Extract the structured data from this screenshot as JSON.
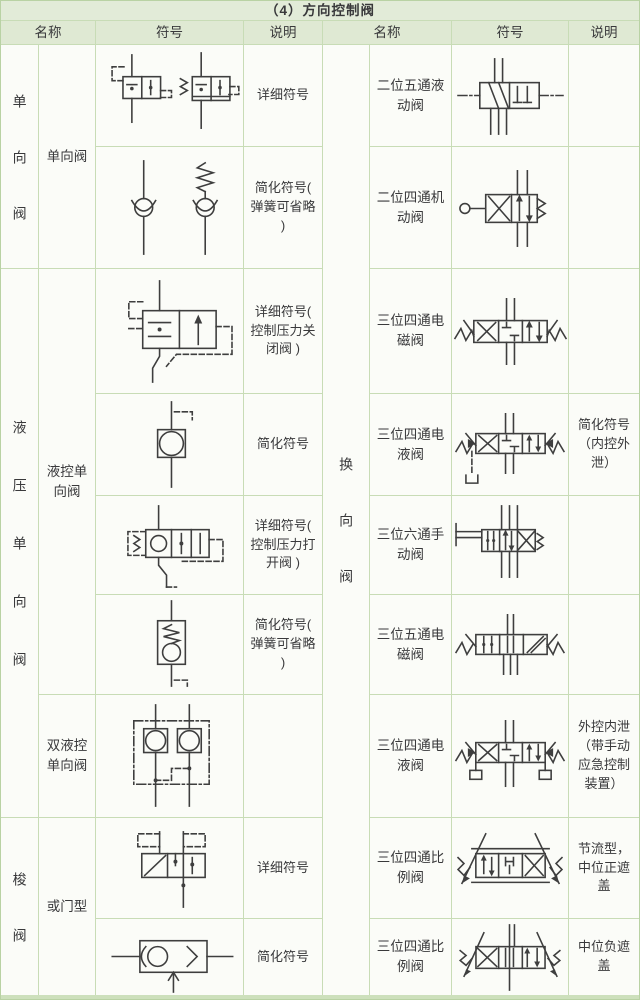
{
  "title": "（4）方向控制阀",
  "columns": {
    "name": "名称",
    "symbol": "符号",
    "desc": "说明"
  },
  "colors": {
    "header_bg": "#dfe9d3",
    "title_bg": "#e2ebd8",
    "grid_line": "#c8dcb6",
    "outer_border": "#b9d2a4",
    "ink": "#39393b",
    "symbol_ink": "#3e3e3e"
  },
  "left": {
    "groups": [
      {
        "label": "单向阀"
      },
      {
        "label": "液压单向阀"
      },
      {
        "label": "梭阀"
      }
    ],
    "subnames": [
      {
        "name": "单向阀"
      },
      {
        "name": "液控单向阀"
      },
      {
        "name": "双液控单向阀"
      },
      {
        "name": "或门型"
      }
    ],
    "rows": [
      {
        "desc": "详细符号",
        "symbol": "check-valve-detailed"
      },
      {
        "desc": "简化符号( 弹簧可省略 )",
        "symbol": "check-valve-simplified"
      },
      {
        "desc": "详细符号( 控制压力关闭阀 )",
        "symbol": "pilot-check-valve-close-detailed"
      },
      {
        "desc": "简化符号",
        "symbol": "pilot-check-valve-simplified"
      },
      {
        "desc": "详细符号( 控制压力打开阀 )",
        "symbol": "pilot-check-valve-open-detailed"
      },
      {
        "desc": "简化符号( 弹簧可省略 )",
        "symbol": "pilot-check-valve-spring-simplified"
      },
      {
        "desc": "",
        "symbol": "double-pilot-check-valve"
      },
      {
        "desc": "详细符号",
        "symbol": "shuttle-valve-detailed"
      },
      {
        "desc": "简化符号",
        "symbol": "shuttle-valve-simplified"
      }
    ]
  },
  "right": {
    "label": "换向阀",
    "rows": [
      {
        "name": "二位五通液动阀",
        "desc": "",
        "symbol": "2pos-5way-hydraulic-valve"
      },
      {
        "name": "二位四通机动阀",
        "desc": "",
        "symbol": "2pos-4way-mechanical-valve"
      },
      {
        "name": "三位四通电磁阀",
        "desc": "",
        "symbol": "3pos-4way-solenoid-valve"
      },
      {
        "name": "三位四通电液阀",
        "desc": "简化符号（内控外泄）",
        "symbol": "3pos-4way-electrohydraulic-valve-simplified"
      },
      {
        "name": "三位六通手动阀",
        "desc": "",
        "symbol": "3pos-6way-manual-valve"
      },
      {
        "name": "三位五通电磁阀",
        "desc": "",
        "symbol": "3pos-5way-solenoid-valve"
      },
      {
        "name": "三位四通电液阀",
        "desc": "外控内泄（带手动应急控制装置）",
        "symbol": "3pos-4way-electrohydraulic-valve"
      },
      {
        "name": "三位四通比例阀",
        "desc": "节流型，中位正遮盖",
        "symbol": "3pos-4way-proportional-valve-positive"
      },
      {
        "name": "三位四通比例阀",
        "desc": "中位负遮盖",
        "symbol": "3pos-4way-proportional-valve-negative"
      }
    ]
  }
}
